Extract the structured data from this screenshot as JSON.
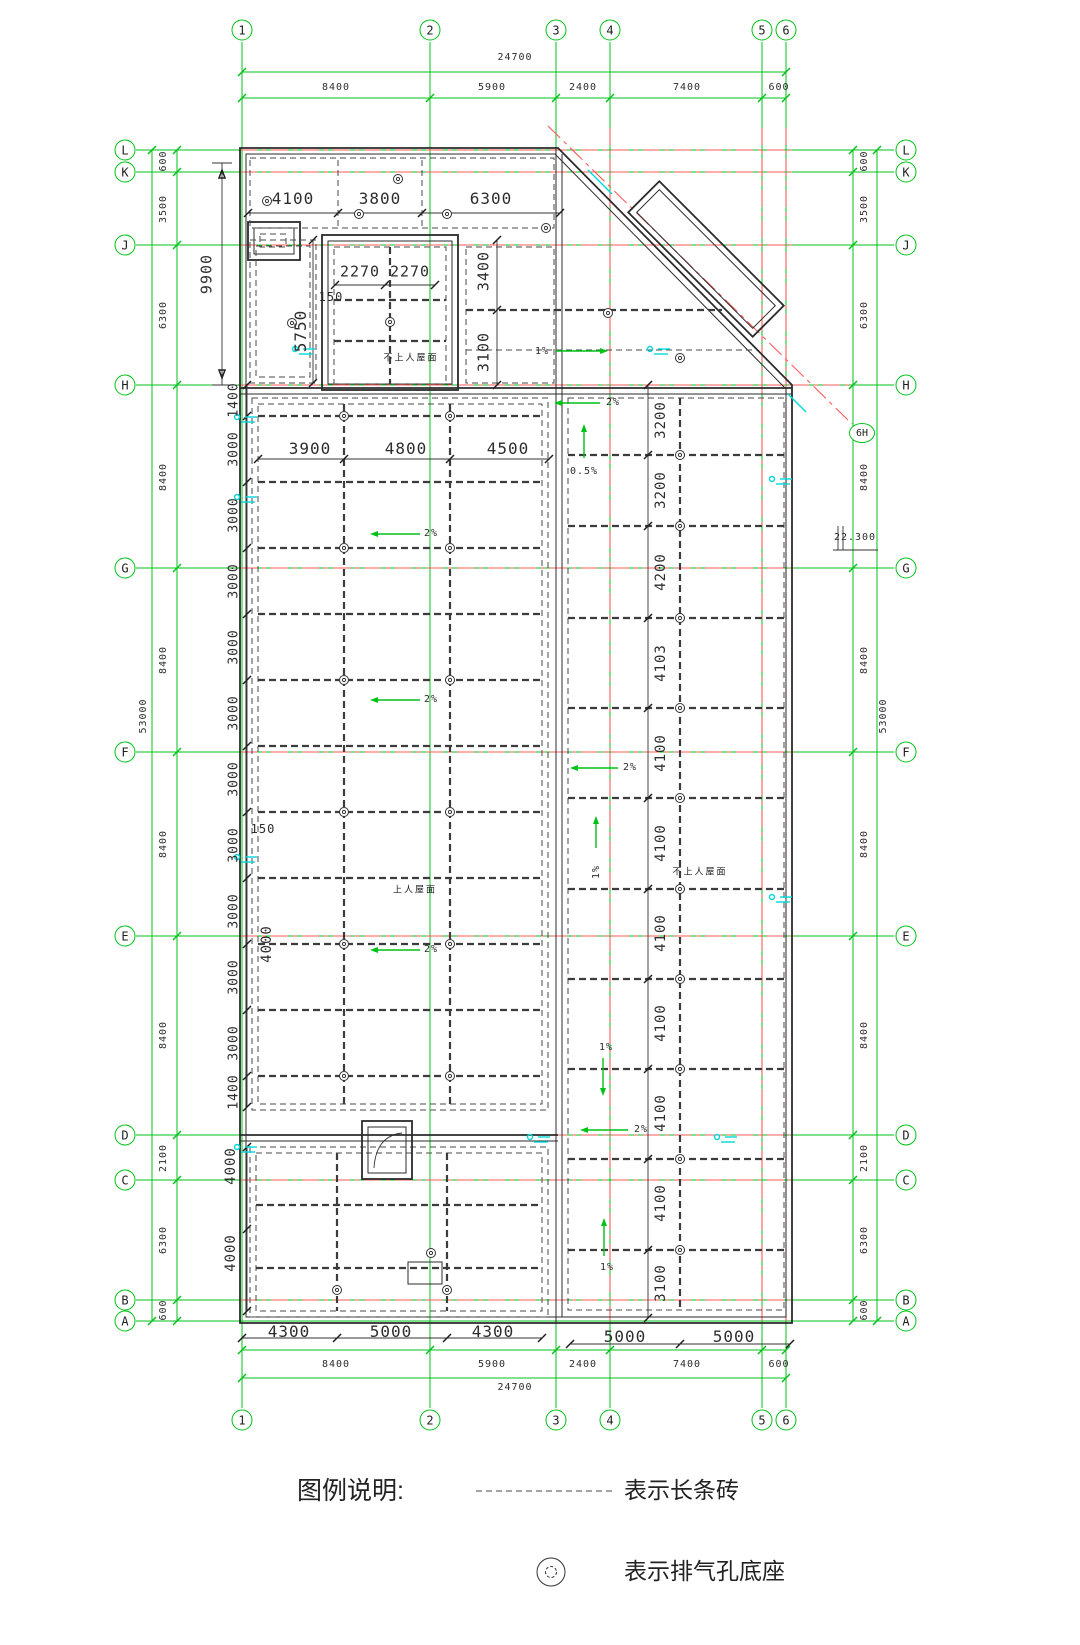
{
  "drawing": {
    "kind": "roof-plan-cad"
  },
  "colors": {
    "grid_green": "#00c217",
    "centerline_red": "#ff5a5a",
    "wall": "#2b2b2b",
    "cyan": "#00d9d9"
  },
  "axis": {
    "top": [
      "1",
      "2",
      "3",
      "4",
      "5",
      "6"
    ],
    "bottom": [
      "1",
      "2",
      "3",
      "4",
      "5",
      "6"
    ],
    "left": [
      "L",
      "K",
      "J",
      "H",
      "G",
      "F",
      "E",
      "D",
      "C",
      "B",
      "A"
    ],
    "right": [
      "L",
      "K",
      "J",
      "H",
      "G",
      "F",
      "E",
      "D",
      "C",
      "B",
      "A"
    ],
    "extra_bubble": "6H"
  },
  "legend": {
    "title": "图例说明:",
    "items": [
      {
        "symbol": "dashed-line",
        "label": "表示长条砖"
      },
      {
        "symbol": "vent-base",
        "label": "表示排气孔底座"
      }
    ]
  },
  "roof_labels": {
    "accessible": "上人屋面",
    "non_accessible_top": "不上人屋面",
    "non_accessible_right": "不上人屋面"
  },
  "elevation": "22.300",
  "annotations": [
    {
      "name": "dim-top-total",
      "text": "24700",
      "x": 515,
      "y": 58,
      "fs": 10,
      "rot": 0
    },
    {
      "name": "dim-top-seg",
      "text": "8400",
      "x": 336,
      "y": 88,
      "fs": 10,
      "rot": 0
    },
    {
      "name": "dim-top-seg",
      "text": "5900",
      "x": 492,
      "y": 88,
      "fs": 10,
      "rot": 0
    },
    {
      "name": "dim-top-seg",
      "text": "2400",
      "x": 583,
      "y": 88,
      "fs": 10,
      "rot": 0
    },
    {
      "name": "dim-top-seg",
      "text": "7400",
      "x": 687,
      "y": 88,
      "fs": 10,
      "rot": 0
    },
    {
      "name": "dim-top-seg",
      "text": "600",
      "x": 779,
      "y": 88,
      "fs": 10,
      "rot": 0
    },
    {
      "name": "dim-bottom-inner",
      "text": "4300",
      "x": 289,
      "y": 1332,
      "fs": 16,
      "rot": 0
    },
    {
      "name": "dim-bottom-inner",
      "text": "5000",
      "x": 391,
      "y": 1332,
      "fs": 16,
      "rot": 0
    },
    {
      "name": "dim-bottom-inner",
      "text": "4300",
      "x": 493,
      "y": 1332,
      "fs": 16,
      "rot": 0
    },
    {
      "name": "dim-bottom-inner",
      "text": "5000",
      "x": 625,
      "y": 1337,
      "fs": 16,
      "rot": 0
    },
    {
      "name": "dim-bottom-inner",
      "text": "5000",
      "x": 734,
      "y": 1337,
      "fs": 16,
      "rot": 0
    },
    {
      "name": "dim-bottom-seg",
      "text": "8400",
      "x": 336,
      "y": 1365,
      "fs": 10,
      "rot": 0
    },
    {
      "name": "dim-bottom-seg",
      "text": "5900",
      "x": 492,
      "y": 1365,
      "fs": 10,
      "rot": 0
    },
    {
      "name": "dim-bottom-seg",
      "text": "2400",
      "x": 583,
      "y": 1365,
      "fs": 10,
      "rot": 0
    },
    {
      "name": "dim-bottom-seg",
      "text": "7400",
      "x": 687,
      "y": 1365,
      "fs": 10,
      "rot": 0
    },
    {
      "name": "dim-bottom-seg",
      "text": "600",
      "x": 779,
      "y": 1365,
      "fs": 10,
      "rot": 0
    },
    {
      "name": "dim-bottom-total",
      "text": "24700",
      "x": 515,
      "y": 1388,
      "fs": 10,
      "rot": 0
    },
    {
      "name": "dim-left",
      "text": "600",
      "x": 164,
      "y": 161,
      "fs": 10,
      "rot": -90
    },
    {
      "name": "dim-left",
      "text": "3500",
      "x": 164,
      "y": 209,
      "fs": 10,
      "rot": -90
    },
    {
      "name": "dim-left",
      "text": "6300",
      "x": 164,
      "y": 315,
      "fs": 10,
      "rot": -90
    },
    {
      "name": "dim-left",
      "text": "8400",
      "x": 164,
      "y": 477,
      "fs": 10,
      "rot": -90
    },
    {
      "name": "dim-left",
      "text": "8400",
      "x": 164,
      "y": 660,
      "fs": 10,
      "rot": -90
    },
    {
      "name": "dim-left",
      "text": "8400",
      "x": 164,
      "y": 844,
      "fs": 10,
      "rot": -90
    },
    {
      "name": "dim-left",
      "text": "8400",
      "x": 164,
      "y": 1035,
      "fs": 10,
      "rot": -90
    },
    {
      "name": "dim-left",
      "text": "2100",
      "x": 164,
      "y": 1158,
      "fs": 10,
      "rot": -90
    },
    {
      "name": "dim-left",
      "text": "6300",
      "x": 164,
      "y": 1240,
      "fs": 10,
      "rot": -90
    },
    {
      "name": "dim-left",
      "text": "600",
      "x": 164,
      "y": 1310,
      "fs": 10,
      "rot": -90
    },
    {
      "name": "dim-left-total",
      "text": "53000",
      "x": 144,
      "y": 716,
      "fs": 10,
      "rot": -90
    },
    {
      "name": "dim-right",
      "text": "600",
      "x": 865,
      "y": 161,
      "fs": 10,
      "rot": -90
    },
    {
      "name": "dim-right",
      "text": "3500",
      "x": 865,
      "y": 209,
      "fs": 10,
      "rot": -90
    },
    {
      "name": "dim-right",
      "text": "6300",
      "x": 865,
      "y": 315,
      "fs": 10,
      "rot": -90
    },
    {
      "name": "dim-right",
      "text": "8400",
      "x": 865,
      "y": 477,
      "fs": 10,
      "rot": -90
    },
    {
      "name": "dim-right",
      "text": "8400",
      "x": 865,
      "y": 660,
      "fs": 10,
      "rot": -90
    },
    {
      "name": "dim-right",
      "text": "8400",
      "x": 865,
      "y": 844,
      "fs": 10,
      "rot": -90
    },
    {
      "name": "dim-right",
      "text": "8400",
      "x": 865,
      "y": 1035,
      "fs": 10,
      "rot": -90
    },
    {
      "name": "dim-right",
      "text": "2100",
      "x": 865,
      "y": 1158,
      "fs": 10,
      "rot": -90
    },
    {
      "name": "dim-right",
      "text": "6300",
      "x": 865,
      "y": 1240,
      "fs": 10,
      "rot": -90
    },
    {
      "name": "dim-right",
      "text": "600",
      "x": 865,
      "y": 1310,
      "fs": 10,
      "rot": -90
    },
    {
      "name": "dim-right-total",
      "text": "53000",
      "x": 884,
      "y": 716,
      "fs": 10,
      "rot": -90
    },
    {
      "name": "dim-9900",
      "text": "9900",
      "x": 207,
      "y": 274,
      "fs": 15,
      "rot": -90
    },
    {
      "name": "dim-room",
      "text": "4100",
      "x": 293,
      "y": 199,
      "fs": 16,
      "rot": 0
    },
    {
      "name": "dim-room",
      "text": "3800",
      "x": 380,
      "y": 199,
      "fs": 16,
      "rot": 0
    },
    {
      "name": "dim-room",
      "text": "6300",
      "x": 491,
      "y": 199,
      "fs": 16,
      "rot": 0
    },
    {
      "name": "dim-room",
      "text": "2270",
      "x": 360,
      "y": 272,
      "fs": 15,
      "rot": 0
    },
    {
      "name": "dim-room",
      "text": "2270",
      "x": 410,
      "y": 272,
      "fs": 15,
      "rot": 0
    },
    {
      "name": "dim-room",
      "text": "150",
      "x": 331,
      "y": 297,
      "fs": 12,
      "rot": 0
    },
    {
      "name": "dim-room",
      "text": "5750",
      "x": 301,
      "y": 331,
      "fs": 16,
      "rot": -90
    },
    {
      "name": "dim-room",
      "text": "3400",
      "x": 484,
      "y": 271,
      "fs": 15,
      "rot": -90
    },
    {
      "name": "dim-room",
      "text": "3100",
      "x": 484,
      "y": 352,
      "fs": 15,
      "rot": -90
    },
    {
      "name": "dim-main",
      "text": "3900",
      "x": 310,
      "y": 449,
      "fs": 16,
      "rot": 0
    },
    {
      "name": "dim-main",
      "text": "4800",
      "x": 406,
      "y": 449,
      "fs": 16,
      "rot": 0
    },
    {
      "name": "dim-main",
      "text": "4500",
      "x": 508,
      "y": 449,
      "fs": 16,
      "rot": 0
    },
    {
      "name": "dim-chain-left",
      "text": "1400",
      "x": 234,
      "y": 400,
      "fs": 13,
      "rot": -90
    },
    {
      "name": "dim-chain-left",
      "text": "3000",
      "x": 234,
      "y": 449,
      "fs": 13,
      "rot": -90
    },
    {
      "name": "dim-chain-left",
      "text": "3000",
      "x": 234,
      "y": 515,
      "fs": 13,
      "rot": -90
    },
    {
      "name": "dim-chain-left",
      "text": "3000",
      "x": 234,
      "y": 581,
      "fs": 13,
      "rot": -90
    },
    {
      "name": "dim-chain-left",
      "text": "3000",
      "x": 234,
      "y": 647,
      "fs": 13,
      "rot": -90
    },
    {
      "name": "dim-chain-left",
      "text": "3000",
      "x": 234,
      "y": 713,
      "fs": 13,
      "rot": -90
    },
    {
      "name": "dim-chain-left",
      "text": "3000",
      "x": 234,
      "y": 779,
      "fs": 13,
      "rot": -90
    },
    {
      "name": "dim-chain-left",
      "text": "3000",
      "x": 234,
      "y": 845,
      "fs": 13,
      "rot": -90
    },
    {
      "name": "dim-chain-left",
      "text": "3000",
      "x": 234,
      "y": 911,
      "fs": 13,
      "rot": -90
    },
    {
      "name": "dim-chain-left",
      "text": "3000",
      "x": 234,
      "y": 977,
      "fs": 13,
      "rot": -90
    },
    {
      "name": "dim-chain-left",
      "text": "3000",
      "x": 234,
      "y": 1043,
      "fs": 13,
      "rot": -90
    },
    {
      "name": "dim-chain-left",
      "text": "1400",
      "x": 234,
      "y": 1092,
      "fs": 13,
      "rot": -90
    },
    {
      "name": "dim-parapet",
      "text": "150",
      "x": 263,
      "y": 829,
      "fs": 12,
      "rot": 0
    },
    {
      "name": "dim-parapet",
      "text": "4000",
      "x": 267,
      "y": 944,
      "fs": 14,
      "rot": -90
    },
    {
      "name": "dim-col-right",
      "text": "3200",
      "x": 661,
      "y": 420,
      "fs": 14,
      "rot": -90
    },
    {
      "name": "dim-col-right",
      "text": "3200",
      "x": 661,
      "y": 490,
      "fs": 14,
      "rot": -90
    },
    {
      "name": "dim-col-right",
      "text": "4200",
      "x": 661,
      "y": 572,
      "fs": 14,
      "rot": -90
    },
    {
      "name": "dim-col-right",
      "text": "4103",
      "x": 661,
      "y": 663,
      "fs": 14,
      "rot": -90
    },
    {
      "name": "dim-col-right",
      "text": "4100",
      "x": 661,
      "y": 753,
      "fs": 14,
      "rot": -90
    },
    {
      "name": "dim-col-right",
      "text": "4100",
      "x": 661,
      "y": 843,
      "fs": 14,
      "rot": -90
    },
    {
      "name": "dim-col-right",
      "text": "4100",
      "x": 661,
      "y": 933,
      "fs": 14,
      "rot": -90
    },
    {
      "name": "dim-col-right",
      "text": "4100",
      "x": 661,
      "y": 1023,
      "fs": 14,
      "rot": -90
    },
    {
      "name": "dim-col-right",
      "text": "4100",
      "x": 661,
      "y": 1113,
      "fs": 14,
      "rot": -90
    },
    {
      "name": "dim-col-right",
      "text": "4100",
      "x": 661,
      "y": 1203,
      "fs": 14,
      "rot": -90
    },
    {
      "name": "dim-col-right",
      "text": "3100",
      "x": 661,
      "y": 1283,
      "fs": 14,
      "rot": -90
    },
    {
      "name": "dim-bottom-block",
      "text": "4000",
      "x": 231,
      "y": 1166,
      "fs": 14,
      "rot": -90
    },
    {
      "name": "dim-bottom-block",
      "text": "4000",
      "x": 231,
      "y": 1253,
      "fs": 14,
      "rot": -90
    },
    {
      "name": "elevation-mark",
      "text": "22.300",
      "x": 855,
      "y": 538,
      "fs": 10,
      "rot": 0
    },
    {
      "name": "slope-label",
      "text": "1%",
      "x": 542,
      "y": 352,
      "fs": 10,
      "rot": 0
    },
    {
      "name": "slope-label",
      "text": "2%",
      "x": 613,
      "y": 403,
      "fs": 10,
      "rot": 0
    },
    {
      "name": "slope-label",
      "text": "0.5%",
      "x": 584,
      "y": 472,
      "fs": 10,
      "rot": 0
    },
    {
      "name": "slope-label",
      "text": "2%",
      "x": 431,
      "y": 534,
      "fs": 10,
      "rot": 0
    },
    {
      "name": "slope-label",
      "text": "2%",
      "x": 431,
      "y": 700,
      "fs": 10,
      "rot": 0
    },
    {
      "name": "slope-label",
      "text": "2%",
      "x": 630,
      "y": 768,
      "fs": 10,
      "rot": 0
    },
    {
      "name": "slope-label",
      "text": "1%",
      "x": 597,
      "y": 872,
      "fs": 10,
      "rot": -90
    },
    {
      "name": "slope-label",
      "text": "2%",
      "x": 431,
      "y": 950,
      "fs": 10,
      "rot": 0
    },
    {
      "name": "slope-label",
      "text": "1%",
      "x": 606,
      "y": 1048,
      "fs": 10,
      "rot": 0
    },
    {
      "name": "slope-label",
      "text": "2%",
      "x": 641,
      "y": 1130,
      "fs": 10,
      "rot": 0
    },
    {
      "name": "slope-label",
      "text": "1%",
      "x": 607,
      "y": 1268,
      "fs": 10,
      "rot": 0
    },
    {
      "name": "roof-label-top",
      "text": "不上人屋面",
      "x": 411,
      "y": 358,
      "fs": 9,
      "rot": 0
    },
    {
      "name": "roof-label-main",
      "text": "上人屋面",
      "x": 415,
      "y": 890,
      "fs": 9,
      "rot": 0
    },
    {
      "name": "roof-label-right",
      "text": "不上人屋面",
      "x": 700,
      "y": 872,
      "fs": 9,
      "rot": 0
    }
  ]
}
